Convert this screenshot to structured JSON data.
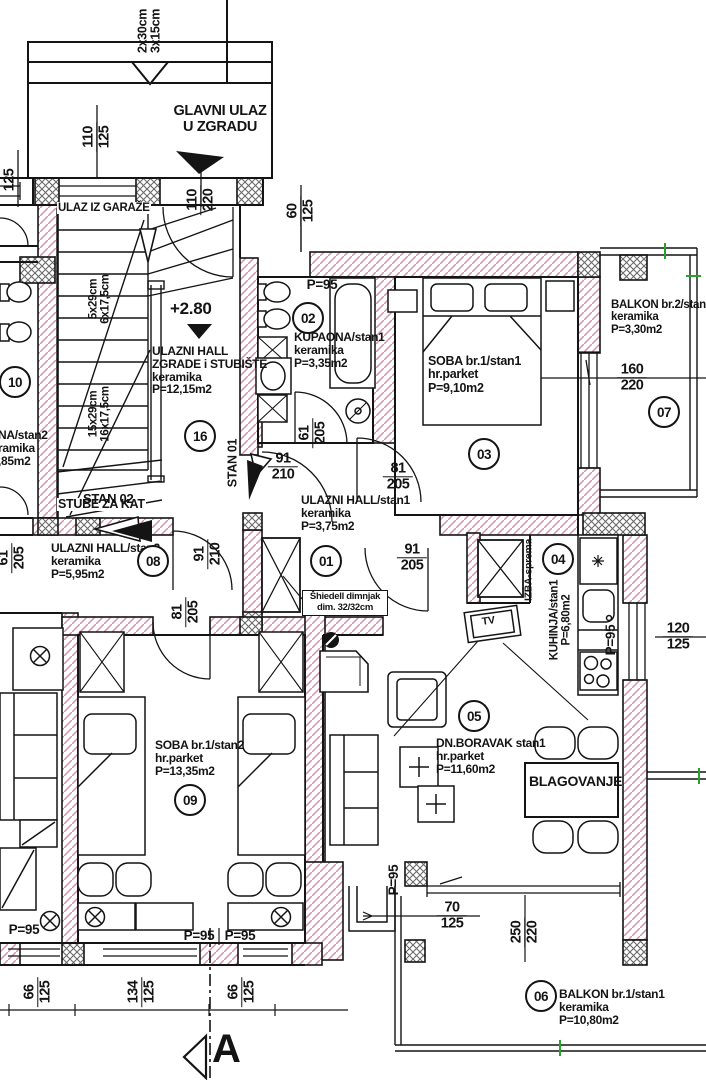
{
  "colors": {
    "wall_hatch_pink": "#d593a9",
    "crosshatch_gray": "#6a6a6a",
    "line_black": "#141414",
    "survey_mark_green": "#27a327"
  },
  "entrance": {
    "steps_l1": "2x30cm",
    "steps_l2": "3x15cm",
    "main_l1": "GLAVNI ULAZ",
    "main_l2": "U ZGRADU",
    "garage": "ULAZ IZ GARAŽE"
  },
  "stairs": {
    "upper_l1": "5x29cm",
    "upper_l2": "6x17,5cm",
    "lower_l1": "15x29cm",
    "lower_l2": "16x17,5cm",
    "to_floor": "STUBE ZA KAT",
    "level": "+2.80"
  },
  "apartments": {
    "stan1": "STAN 01",
    "stan2": "STAN 02"
  },
  "rooms": {
    "hall_building": {
      "num": "16",
      "l1": "ULAZNI HALL",
      "l2": "ZGRADE i STUBIŠTE",
      "l3": "keramika",
      "l4": "P=12,15m2"
    },
    "kupaona_s1": {
      "num": "02",
      "l1": "KUPAONA/stan1",
      "l2": "keramika",
      "l3": "P=3,35m2"
    },
    "soba1_s1": {
      "num": "03",
      "l1": "SOBA br.1/stan1",
      "l2": "hr.parket",
      "l3": "P=9,10m2"
    },
    "balkon2_s1": {
      "num": "07",
      "l1": "BALKON br.2/stan1",
      "l2": "keramika",
      "l3": "P=3,30m2"
    },
    "hall_s1": {
      "num": "01",
      "l1": "ULAZNI HALL/stan1",
      "l2": "keramika",
      "l3": "P=3,75m2"
    },
    "hall_s2": {
      "num": "08",
      "l1": "ULAZNI HALL/stan2",
      "l2": "keramika",
      "l3": "P=5,95m2"
    },
    "izba": {
      "num": "04",
      "label": "IZBA-sprema"
    },
    "kuhinja_s1": {
      "l1": "KUHINJA/stan1",
      "l2": "P=6,80m2"
    },
    "boravak_s1": {
      "num": "05",
      "l1": "DN.BORAVAK stan1",
      "l2": "hr.parket",
      "l3": "P=11,60m2"
    },
    "soba1_s2": {
      "num": "09",
      "l1": "SOBA br.1/stan2",
      "l2": "hr.parket",
      "l3": "P=13,35m2"
    },
    "balkon1_s1": {
      "num": "06",
      "l1": "BALKON br.1/stan1",
      "l2": "keramika",
      "l3": "P=10,80m2"
    },
    "neighbor": {
      "num": "10",
      "l1": "NA/stan2",
      "l2": "ramika",
      "l3": ",85m2"
    }
  },
  "fixtures": {
    "tv": "TV",
    "dining": "BLAGOVANJE",
    "chimney_l1": "Šhiedell dimnjak",
    "chimney_l2": "dim. 32/32cm",
    "sill": "P=95"
  },
  "section": {
    "label": "A"
  },
  "dims": {
    "d125": "125",
    "d110_125": {
      "a": "110",
      "b": "125"
    },
    "d110_220": {
      "a": "110",
      "b": "220"
    },
    "d60_125": {
      "a": "60",
      "b": "125"
    },
    "d61_205": {
      "a": "61",
      "b": "205"
    },
    "d91_210": {
      "a": "91",
      "b": "210"
    },
    "d81_205": {
      "a": "81",
      "b": "205"
    },
    "d91_205": {
      "a": "91",
      "b": "205"
    },
    "d160_220": {
      "a": "160",
      "b": "220"
    },
    "d120_125": {
      "a": "120",
      "b": "125"
    },
    "d70_125": {
      "a": "70",
      "b": "125"
    },
    "d250_220": {
      "a": "250",
      "b": "220"
    },
    "d66_125": {
      "a": "66",
      "b": "125"
    },
    "d134_125": {
      "a": "134",
      "b": "125"
    }
  }
}
